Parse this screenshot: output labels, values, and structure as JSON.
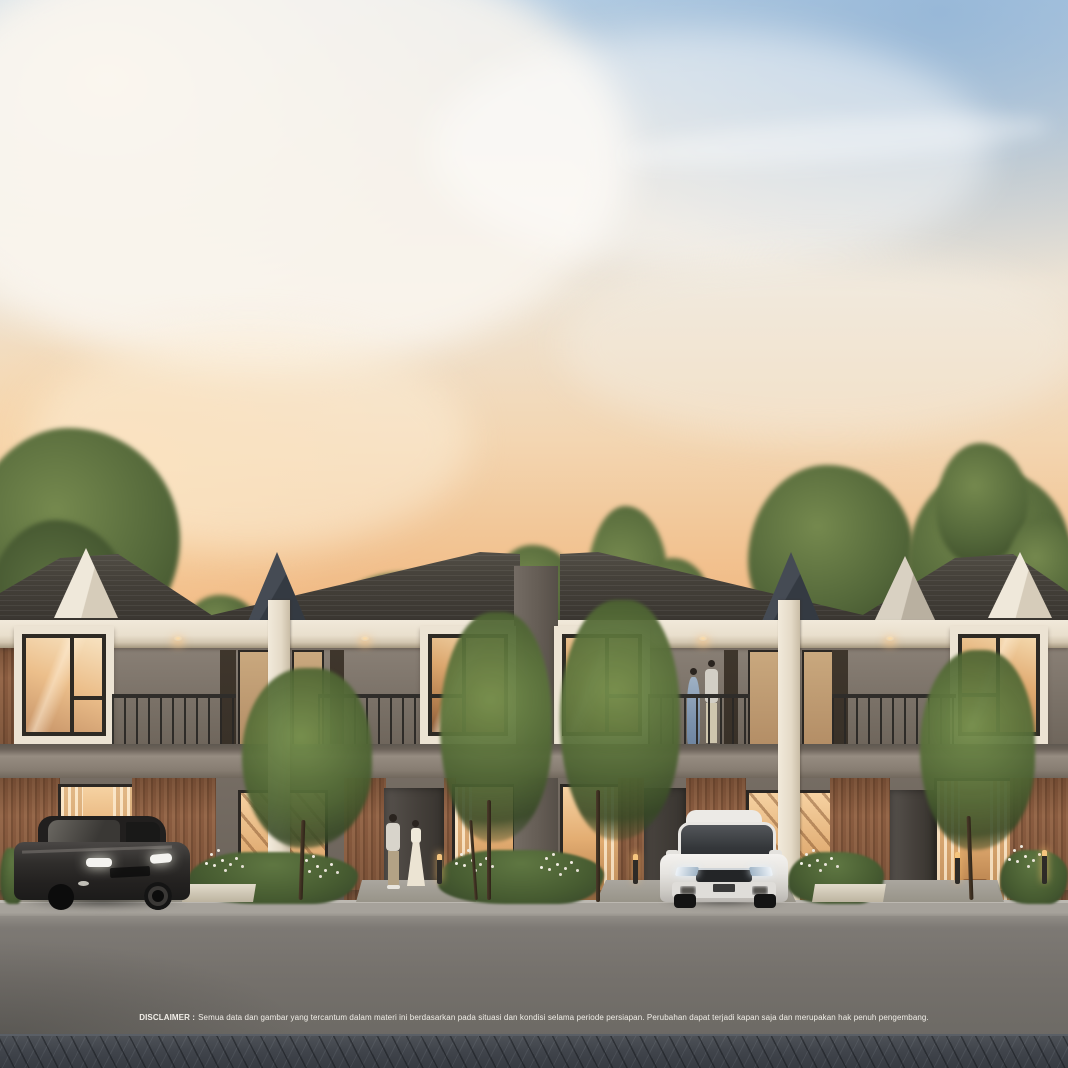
{
  "scene": {
    "description": "Sunset architectural rendering of a row of modern two-storey townhouses with timber-slat facades, cream window frames, balconies, landscaped front yards, a street in the foreground, two parked hatchback cars and residents",
    "time_of_day": "dusk",
    "people": [
      "couple talking on driveway",
      "couple standing on balcony"
    ],
    "vehicles": [
      "dark grey hatchback",
      "white hatchback"
    ]
  },
  "disclaimer": {
    "label": "DISCLAIMER :",
    "text": "Semua data dan gambar yang tercantum dalam materi ini berdasarkan pada situasi dan kondisi selama periode persiapan. Perubahan dapat terjadi kapan saja dan merupakan hak penuh pengembang."
  },
  "palette": {
    "sky-blue": "#b7cfe4",
    "sky-cream": "#eee4d5",
    "sky-peach": "#f3d6b2",
    "sky-horizon": "#efae74",
    "roof": "#45413a",
    "trim": "#ece3d3",
    "wood": "#96684a",
    "glass-warm": "#e3ad72",
    "railing": "#2f2d2a",
    "foliage": "#41522d",
    "road": "#74706b",
    "paver": "#40444b",
    "car-black": "#2b2a28",
    "car-white": "#ebe9e5",
    "disclaimer": "#f1eee8"
  }
}
